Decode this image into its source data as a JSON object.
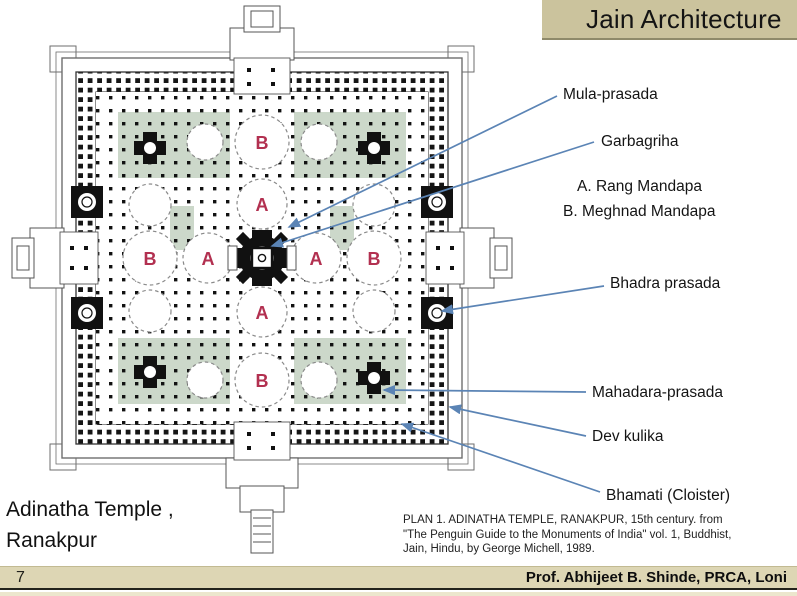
{
  "title": {
    "text": "Jain Architecture"
  },
  "annotations": [
    {
      "id": "mula-prasada",
      "label": "Mula-prasada"
    },
    {
      "id": "garbagriha",
      "label": "Garbagriha"
    },
    {
      "id": "bhadra-prasada",
      "label": "Bhadra prasada"
    },
    {
      "id": "mahadara-prasada",
      "label": "Mahadara-prasada"
    },
    {
      "id": "dev-kulika",
      "label": "Dev kulika"
    },
    {
      "id": "bhamati",
      "label": "Bhamati (Cloister)"
    }
  ],
  "legend": {
    "items": [
      {
        "key": "A",
        "text": "A. Rang Mandapa"
      },
      {
        "key": "B",
        "text": "B. Meghnad Mandapa"
      }
    ]
  },
  "plan": {
    "name": "Adinatha Temple plan, Ranakpur",
    "markers": [
      {
        "label": "A",
        "meaning": "Rang Mandapa"
      },
      {
        "label": "A",
        "meaning": "Rang Mandapa"
      },
      {
        "label": "A",
        "meaning": "Rang Mandapa"
      },
      {
        "label": "A",
        "meaning": "Rang Mandapa"
      },
      {
        "label": "B",
        "meaning": "Meghnad Mandapa"
      },
      {
        "label": "B",
        "meaning": "Meghnad Mandapa"
      },
      {
        "label": "B",
        "meaning": "Meghnad Mandapa"
      },
      {
        "label": "B",
        "meaning": "Meghnad Mandapa"
      }
    ],
    "colors": {
      "marker_letter": "#b23050",
      "leader_line": "#5b84b5",
      "court_green": "#ccd8ca",
      "walls": "#111111"
    }
  },
  "subtitle": {
    "line1": "Adinatha Temple ,",
    "line2": "Ranakpur"
  },
  "footnote": {
    "lines": [
      "PLAN 1. ADINATHA TEMPLE, RANAKPUR, 15th century.  from",
      "\"The Penguin Guide to the Monuments  of India\" vol. 1, Buddhist,",
      "Jain, Hindu,  by George Michell, 1989."
    ]
  },
  "footer": {
    "page": "7",
    "credit": "Prof. Abhijeet B. Shinde, PRCA, Loni"
  },
  "ui_colors": {
    "title_bg": "#cbc39d",
    "footer_bg": "#ddd6b4"
  }
}
